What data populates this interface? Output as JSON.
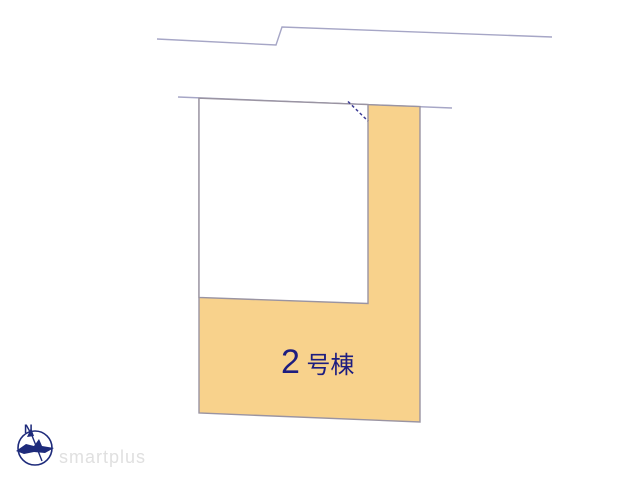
{
  "diagram": {
    "lot_label": {
      "number": "2",
      "suffix": "号棟"
    }
  },
  "compass": {
    "north_label": "N"
  },
  "watermark": {
    "text": "smartplus"
  },
  "colors": {
    "lot_fill": "#F8D28C",
    "parcel_border": "#9A94A2",
    "building_fill": "#FFFFFF",
    "road_line": "#A6A6C6",
    "dashed_line": "#3C3C96",
    "label_text": "#1D1D80",
    "compass": "#1E2B7B",
    "watermark_text": "#E0E0E0"
  }
}
